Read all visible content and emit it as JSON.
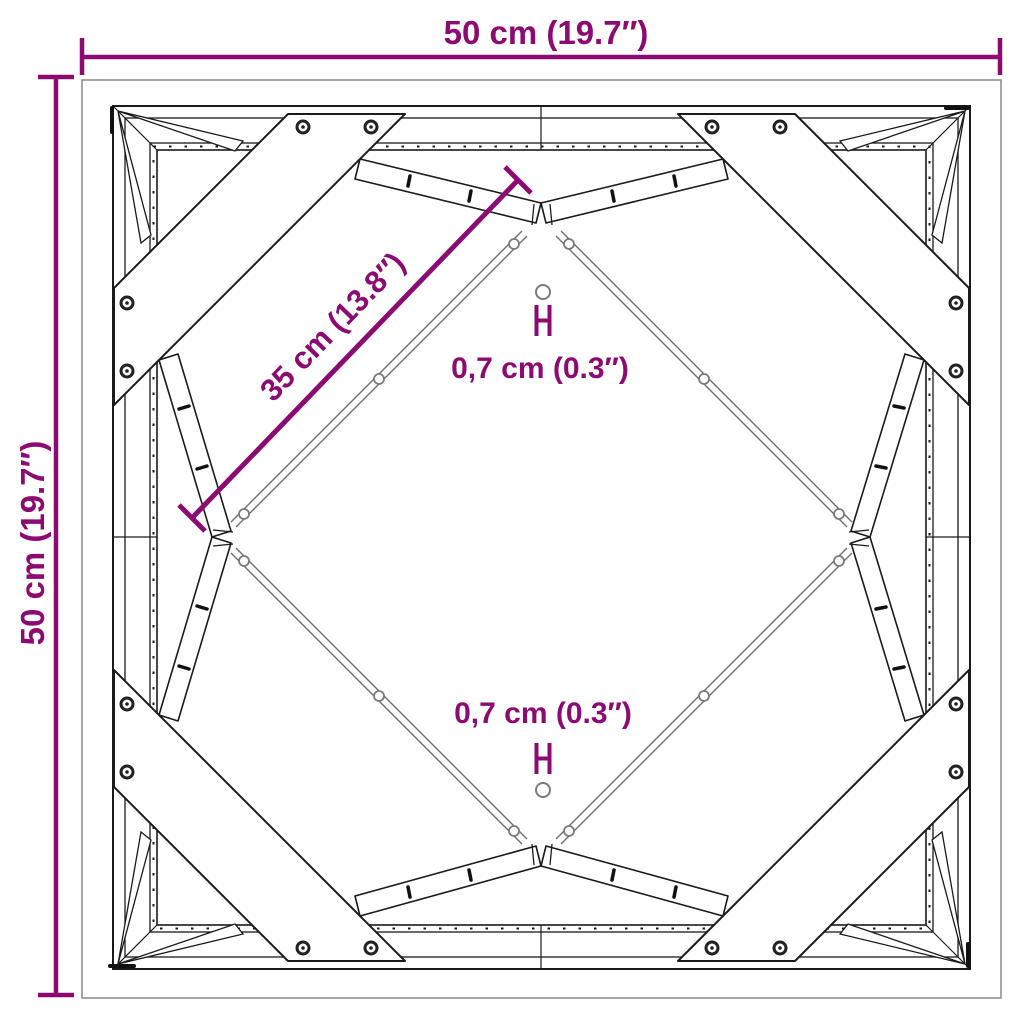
{
  "diagram": {
    "labels": {
      "width": "50 cm (19.7″)",
      "height": "50 cm (19.7″)",
      "diagonal": "35 cm (13.8″)",
      "hole_top": "0,7 cm (0.3″)",
      "hole_bottom": "0,7 cm (0.3″)"
    },
    "colors": {
      "dimension": "#8C0B73",
      "line": "#1A1A1A",
      "flange_line": "#6E6E6E",
      "border": "#8F8F8F",
      "background": "#FFFFFF"
    },
    "icons": {
      "screw_hole": "circle-icon",
      "diameter_bracket": "h-bracket-icon",
      "dimension_tick": "tick-icon"
    }
  }
}
